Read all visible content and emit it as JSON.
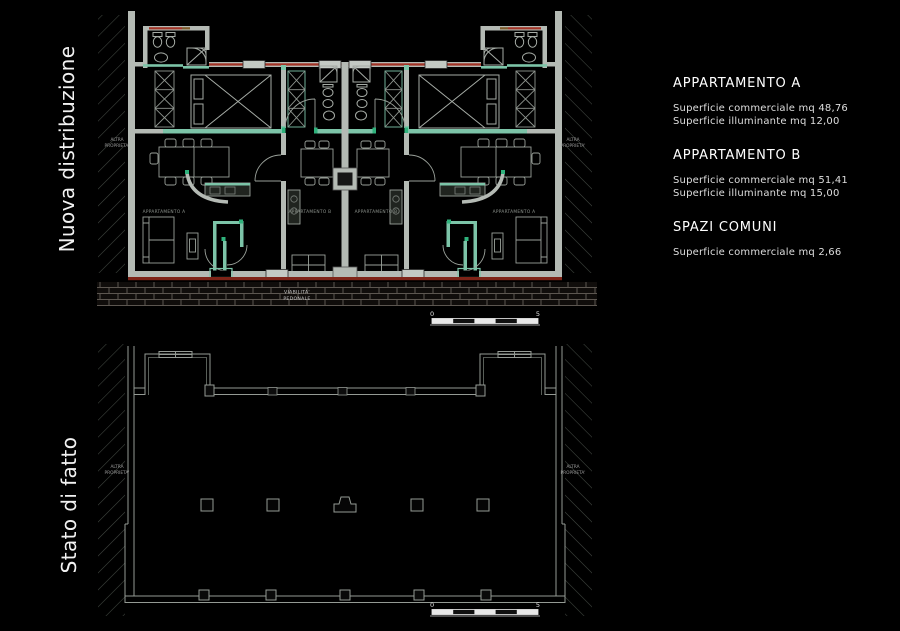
{
  "left_titles": {
    "top": "Nuova distribuzione",
    "bottom": "Stato di fatto"
  },
  "legend": {
    "sections": [
      {
        "heading": "APPARTAMENTO A",
        "lines": [
          "Superficie commerciale mq 48,76",
          "Superficie illuminante mq 12,00"
        ]
      },
      {
        "heading": "APPARTAMENTO B",
        "lines": [
          "Superficie commerciale mq 51,41",
          "Superficie illuminante mq 15,00"
        ]
      },
      {
        "heading": "SPAZI COMUNI",
        "lines": [
          "Superficie commerciale mq 2,66"
        ]
      }
    ]
  },
  "top_plan": {
    "name": "Nuova distribuzione",
    "room_labels": [
      "APPARTAMENTO A",
      "APPARTAMENTO B",
      "APPARTAMENTO B",
      "APPARTAMENTO A"
    ],
    "adjacent_property_line1": "ALTRA",
    "adjacent_property_line2": "PROPRIETA'",
    "walkway_line1": "VIABILITA'",
    "walkway_line2": "PEDONALE",
    "scale": {
      "start": "0",
      "end": "5"
    }
  },
  "bottom_plan": {
    "name": "Stato di fatto",
    "adjacent_property_line1": "ALTRA",
    "adjacent_property_line2": "PROPRIETA'",
    "scale": {
      "start": "0",
      "end": "5"
    }
  },
  "colors": {
    "background": "#000000",
    "walls_gray": "#b4bab4",
    "furniture_lines": "#9aa19a",
    "new_walls_teal": "#7cc4a8",
    "junction_teal": "#2fb27c",
    "demolition_red": "#a23326",
    "walkway_red": "#7e2418",
    "text_white": "#f2f2f2",
    "text_dim": "#8d938d"
  }
}
